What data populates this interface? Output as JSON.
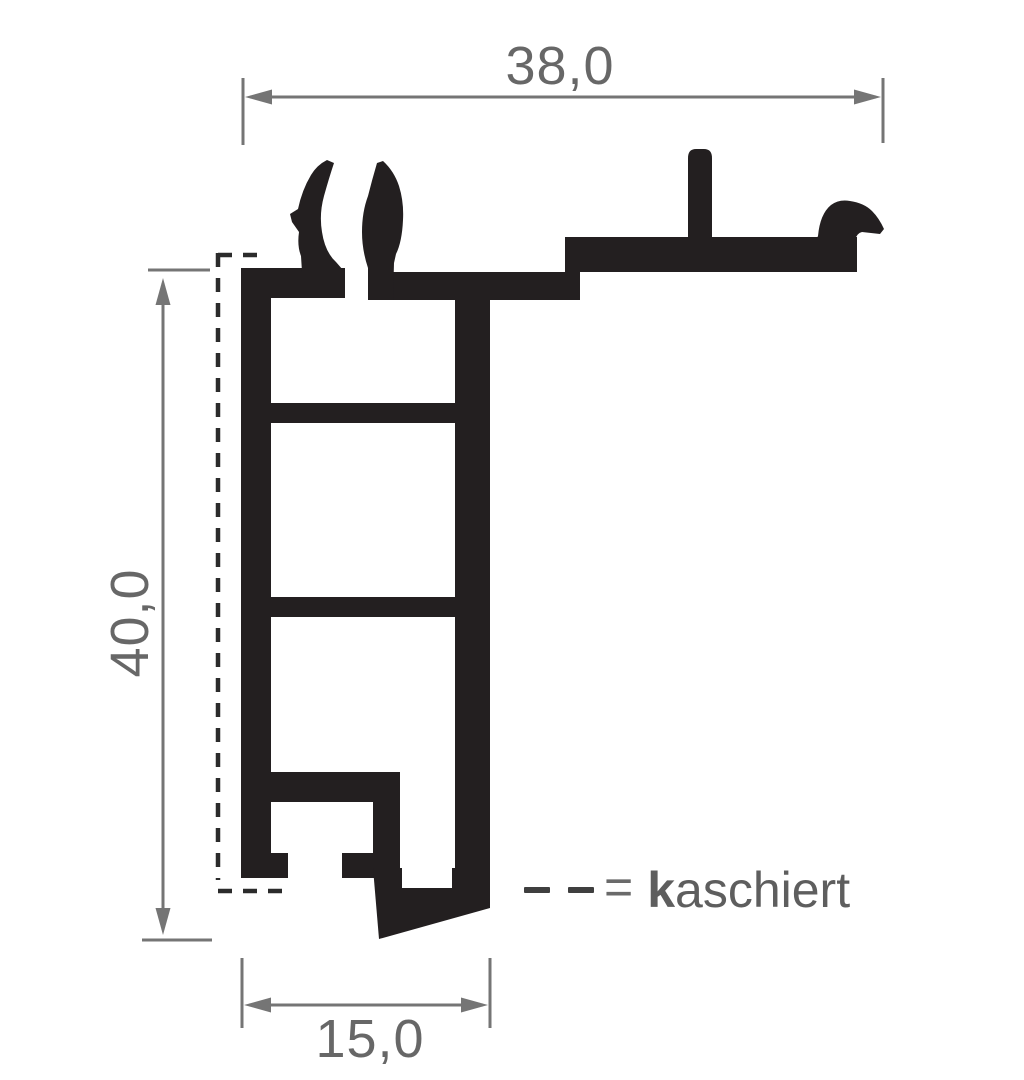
{
  "diagram": {
    "type": "profile-cross-section-drawing",
    "dimensions": {
      "top_width": "38,0",
      "left_height": "40,0",
      "bottom_width": "15,0"
    },
    "legend": {
      "equals": "=",
      "term_bold": "k",
      "term_rest": "aschiert"
    },
    "colors": {
      "profile_fill": "#231f20",
      "dimension_gray": "#757575",
      "label_gray": "#676767",
      "dash_black": "#2b2b2b",
      "background": "#ffffff"
    }
  }
}
